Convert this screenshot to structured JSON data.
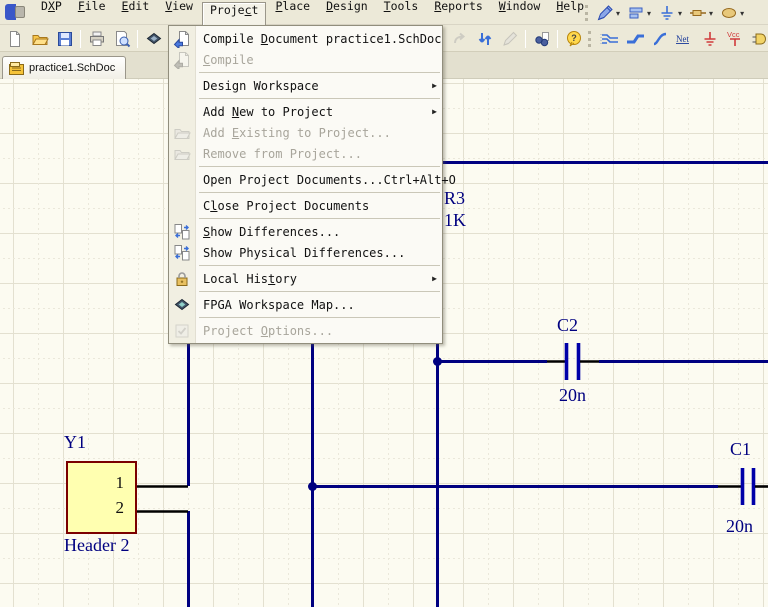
{
  "menu_bar": {
    "items": [
      {
        "name": "dxp",
        "pre": "D",
        "accel": "X",
        "post": "P"
      },
      {
        "name": "file",
        "pre": "",
        "accel": "F",
        "post": "ile"
      },
      {
        "name": "edit",
        "pre": "",
        "accel": "E",
        "post": "dit"
      },
      {
        "name": "view",
        "pre": "",
        "accel": "V",
        "post": "iew"
      },
      {
        "name": "project",
        "pre": "Proje",
        "accel": "c",
        "post": "t",
        "active": true
      },
      {
        "name": "place",
        "pre": "",
        "accel": "P",
        "post": "lace"
      },
      {
        "name": "design",
        "pre": "",
        "accel": "D",
        "post": "esign"
      },
      {
        "name": "tools",
        "pre": "",
        "accel": "T",
        "post": "ools"
      },
      {
        "name": "reports",
        "pre": "",
        "accel": "R",
        "post": "eports"
      },
      {
        "name": "window",
        "pre": "",
        "accel": "W",
        "post": "indow"
      },
      {
        "name": "help",
        "pre": "",
        "accel": "H",
        "post": "elp"
      }
    ]
  },
  "utilities_toolbar": {
    "buttons": [
      {
        "name": "drawing-tools",
        "icon": "pencil-ruler-icon"
      },
      {
        "name": "alignment-tools",
        "icon": "align-icon"
      },
      {
        "name": "power-sources",
        "icon": "power-port-icon"
      },
      {
        "name": "digital-devices",
        "icon": "component-icon"
      },
      {
        "name": "simulation-sources",
        "icon": "ellipse-icon"
      }
    ]
  },
  "main_toolbar": {
    "left": [
      {
        "name": "new-document",
        "icon": "new-doc-icon"
      },
      {
        "name": "open-document",
        "icon": "open-folder-icon"
      },
      {
        "name": "save-document",
        "icon": "save-icon"
      },
      {
        "type": "sep"
      },
      {
        "name": "print",
        "icon": "print-icon"
      },
      {
        "name": "print-preview",
        "icon": "print-preview-icon"
      },
      {
        "type": "sep"
      },
      {
        "name": "open-device-view",
        "icon": "device-view-icon"
      },
      {
        "type": "sep"
      },
      {
        "name": "zoom-area",
        "icon": "zoom-icon"
      }
    ],
    "right": [
      {
        "name": "redo",
        "icon": "redo-icon",
        "disabled": true
      },
      {
        "name": "cross-probe",
        "icon": "sync-arrows-icon"
      },
      {
        "name": "edit",
        "icon": "edit-icon",
        "disabled": true
      },
      {
        "type": "sep"
      },
      {
        "name": "find-similar",
        "icon": "find-icon"
      },
      {
        "type": "sep"
      },
      {
        "name": "help",
        "icon": "help-icon"
      },
      {
        "type": "grip"
      },
      {
        "name": "place-wire",
        "icon": "wire-icon"
      },
      {
        "name": "place-bus",
        "icon": "bus-icon"
      },
      {
        "name": "place-signal-harness",
        "icon": "signal-icon"
      },
      {
        "name": "place-net-label",
        "icon": "net-label-icon"
      },
      {
        "name": "place-gnd-power-port",
        "icon": "gnd-icon"
      },
      {
        "name": "place-vcc-power-port",
        "icon": "vcc-icon"
      },
      {
        "name": "place-part",
        "icon": "gate-icon"
      },
      {
        "name": "place-sheet-symbol",
        "icon": "sheet-symbol-icon"
      }
    ]
  },
  "tab_bar": {
    "active_tab": {
      "label": "practice1.SchDoc",
      "icon": "schdoc-icon"
    }
  },
  "project_menu": {
    "items": [
      {
        "type": "item",
        "name": "compile-document",
        "icon": "compile-doc-icon",
        "pre": "Compile ",
        "accel": "D",
        "post": "ocument practice1.SchDoc"
      },
      {
        "type": "item",
        "name": "compile",
        "icon": "compile-doc-icon",
        "pre": "",
        "accel": "C",
        "post": "ompile",
        "disabled": true
      },
      {
        "type": "separator"
      },
      {
        "type": "item",
        "name": "design-workspace",
        "pre": "Design Workspace",
        "accel": "",
        "post": "",
        "submenu": true
      },
      {
        "type": "separator"
      },
      {
        "type": "item",
        "name": "add-new-to-project",
        "pre": "Add ",
        "accel": "N",
        "post": "ew to Project",
        "submenu": true
      },
      {
        "type": "item",
        "name": "add-existing-to-project",
        "icon": "folder-doc-icon",
        "pre": "Add ",
        "accel": "E",
        "post": "xisting to Project...",
        "disabled": true
      },
      {
        "type": "item",
        "name": "remove-from-project",
        "icon": "folder-doc-icon",
        "pre": "Remove from Project...",
        "accel": "",
        "post": "",
        "disabled": true
      },
      {
        "type": "separator"
      },
      {
        "type": "item",
        "name": "open-project-documents",
        "pre": "Open Project Documents...",
        "accel": "",
        "post": "",
        "shortcut": "Ctrl+Alt+O"
      },
      {
        "type": "separator"
      },
      {
        "type": "item",
        "name": "close-project-documents",
        "pre": "C",
        "accel": "l",
        "post": "ose Project Documents"
      },
      {
        "type": "separator"
      },
      {
        "type": "item",
        "name": "show-differences",
        "icon": "diff-icon",
        "pre": "",
        "accel": "S",
        "post": "how Differences..."
      },
      {
        "type": "item",
        "name": "show-physical-differences",
        "icon": "diff-icon",
        "pre": "Show Physical Differences...",
        "accel": "",
        "post": ""
      },
      {
        "type": "separator"
      },
      {
        "type": "item",
        "name": "local-history",
        "icon": "lock-icon",
        "pre": "Local His",
        "accel": "t",
        "post": "ory",
        "submenu": true
      },
      {
        "type": "separator"
      },
      {
        "type": "item",
        "name": "fpga-workspace-map",
        "icon": "fpga-icon",
        "pre": "FPGA Workspace Map...",
        "accel": "",
        "post": ""
      },
      {
        "type": "separator"
      },
      {
        "type": "item",
        "name": "project-options",
        "icon": "options-icon",
        "pre": "Project ",
        "accel": "O",
        "post": "ptions...",
        "disabled": true
      }
    ]
  },
  "schematic": {
    "labels": {
      "y1": "Y1",
      "y1_comment": "Header 2",
      "pin1": "1",
      "pin2": "2",
      "r3": "R3",
      "r3_value": "1K",
      "c2": "C2",
      "c2_value": "20n",
      "c1": "C1",
      "c1_value": "20n"
    }
  },
  "glyphs": {
    "submenu_arrow": "▶",
    "dropdown_arrow": "▾",
    "net_icon_text": "Net",
    "vcc_icon_text": "Vcc"
  },
  "colors": {
    "wire": "#000080",
    "pin": "#000000",
    "cap": "#0000A8",
    "label": "#000080",
    "part_fill": "#FFFFB0",
    "part_border": "#7B0000",
    "sheet_bg": "#FCFBF1",
    "toolbar_bg": "#ECE9D8",
    "menu_bg": "#FBFAF5",
    "disabled_text": "#A8A59B"
  }
}
